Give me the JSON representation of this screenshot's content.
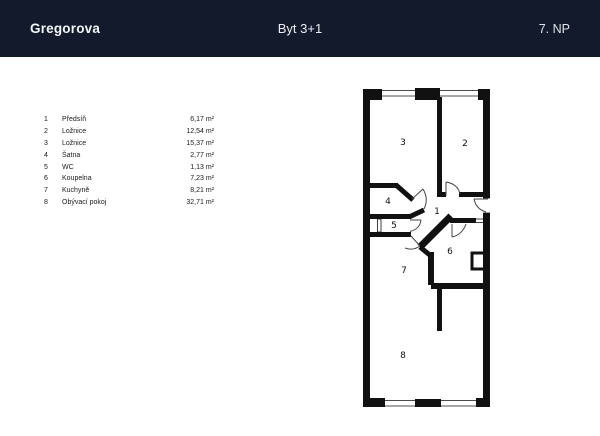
{
  "header": {
    "project": "Gregorova",
    "title": "Byt 3+1",
    "floor": "7. NP"
  },
  "colors": {
    "header_bg": "#131a2b",
    "header_text": "#f5f6f8",
    "wall": "#111111",
    "paper_bg": "#ffffff"
  },
  "legend": {
    "rows": [
      {
        "num": "1",
        "name": "Předsíň",
        "area": "6,17 m²"
      },
      {
        "num": "2",
        "name": "Ložnice",
        "area": "12,54 m²"
      },
      {
        "num": "3",
        "name": "Ložnice",
        "area": "15,37 m²"
      },
      {
        "num": "4",
        "name": "Šatna",
        "area": "2,77 m²"
      },
      {
        "num": "5",
        "name": "WC",
        "area": "1,13 m²"
      },
      {
        "num": "6",
        "name": "Koupelna",
        "area": "7,23 m²"
      },
      {
        "num": "7",
        "name": "Kuchyně",
        "area": "8,21 m²"
      },
      {
        "num": "8",
        "name": "Obývací pokoj",
        "area": "32,71 m²"
      }
    ]
  },
  "plan": {
    "room_labels": {
      "hall": "1",
      "bedroom_right": "2",
      "bedroom_left": "3",
      "closet": "4",
      "wc": "5",
      "bathroom": "6",
      "kitchen": "7",
      "living": "8"
    }
  }
}
